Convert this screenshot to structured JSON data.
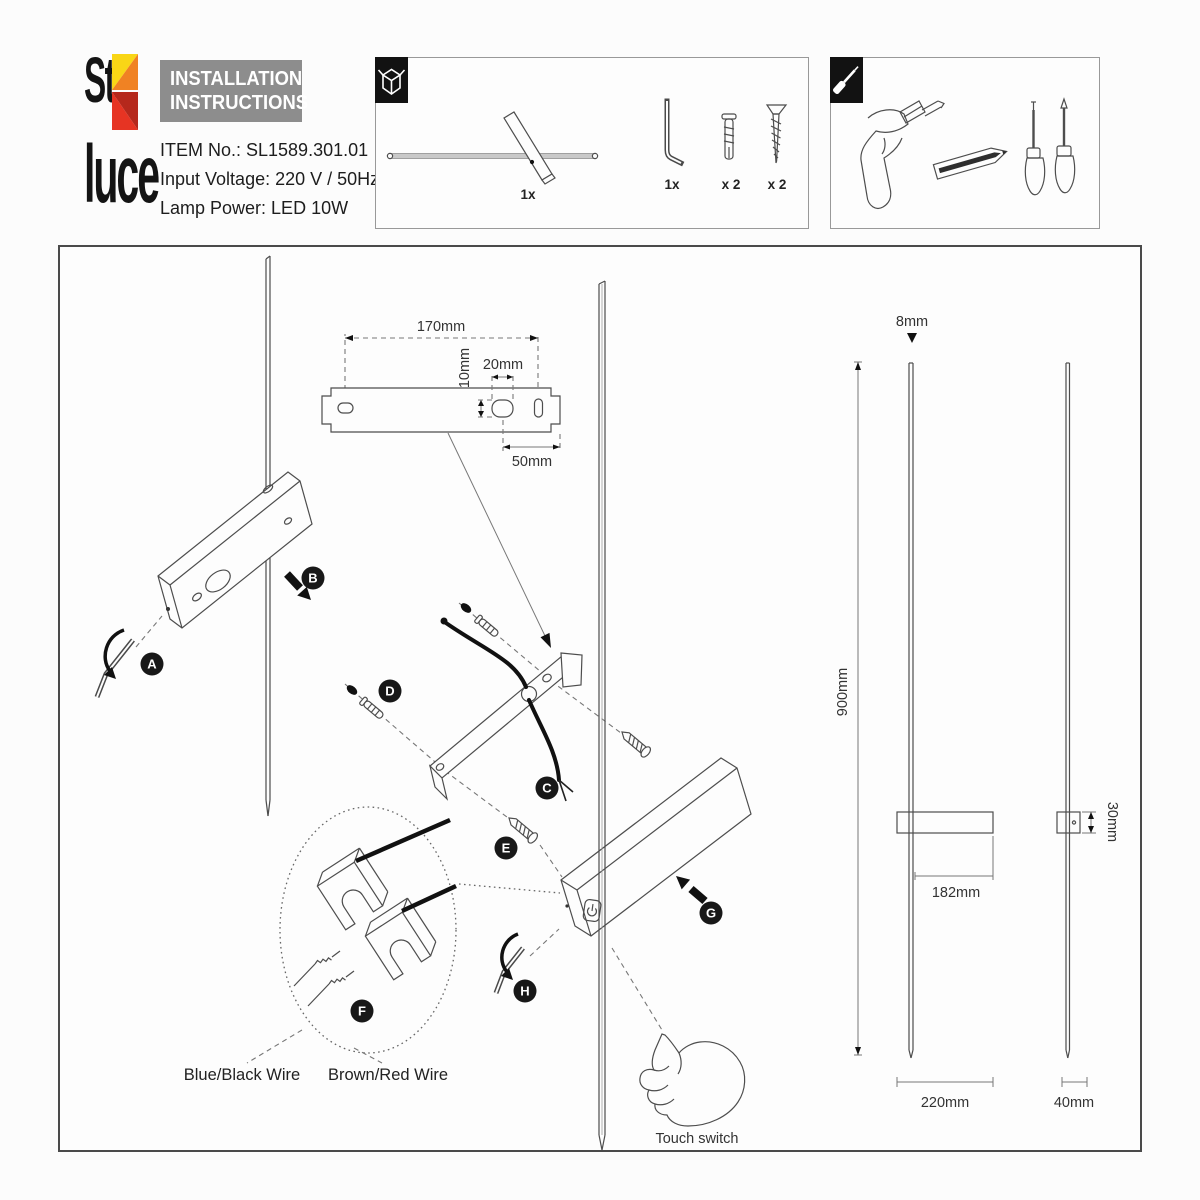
{
  "colors": {
    "logo_yellow": "#f9d616",
    "logo_orange": "#f08223",
    "logo_red": "#e63423",
    "logo_dark_red": "#b5281c",
    "title_bg": "#8d8d8d",
    "line_art": "#4d4d4d",
    "badge_bg": "#181818"
  },
  "header": {
    "logo_top": "St",
    "logo_bottom": "luce",
    "title_line1": "INSTALLATION",
    "title_line2": "INSTRUCTIONS",
    "item_no": "ITEM No.:  SL1589.301.01",
    "input_voltage": "Input Voltage: 220 V / 50Hz",
    "lamp_power": "Lamp Power: LED 10W"
  },
  "package_box": {
    "icon": "open-box-icon",
    "lamp_qty": "1x",
    "allen_key_qty": "1x",
    "wall_plug_qty": "x 2",
    "screw_qty": "x 2"
  },
  "tools_box": {
    "icon": "screwdriver-icon",
    "tools": [
      "drill",
      "pencil",
      "flat-screwdriver",
      "phillips-screwdriver"
    ]
  },
  "diagram": {
    "steps": {
      "a": "A",
      "b": "B",
      "c": "C",
      "d": "D",
      "e": "E",
      "f": "F",
      "g": "G",
      "h": "H"
    },
    "dims": {
      "bracket_length": "170mm",
      "slot_height": "10mm",
      "slot_width": "20mm",
      "slot_offset": "50mm",
      "rod_diameter": "8mm",
      "overall_height": "900mm",
      "body_extension": "182mm",
      "body_height": "30mm",
      "body_width": "220mm",
      "body_depth": "40mm"
    },
    "labels": {
      "wire_blue": "Blue/Black Wire",
      "wire_brown": "Brown/Red Wire",
      "touch_switch": "Touch switch"
    }
  }
}
